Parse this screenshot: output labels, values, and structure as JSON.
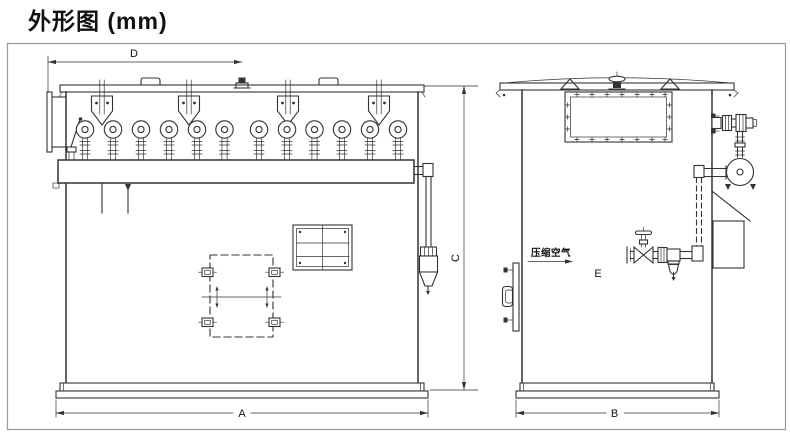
{
  "title": "外形图 (mm)",
  "front_view": {
    "dim_top_width": "D",
    "dim_right_height": "C",
    "dim_bottom_width": "A"
  },
  "side_view": {
    "dim_bottom_width": "B",
    "air_inlet_label": "压缩空气",
    "air_inlet_dim": "E"
  },
  "colors": {
    "line": "#333333",
    "border": "#9a9a9a",
    "background": "#ffffff",
    "text": "#111111"
  }
}
